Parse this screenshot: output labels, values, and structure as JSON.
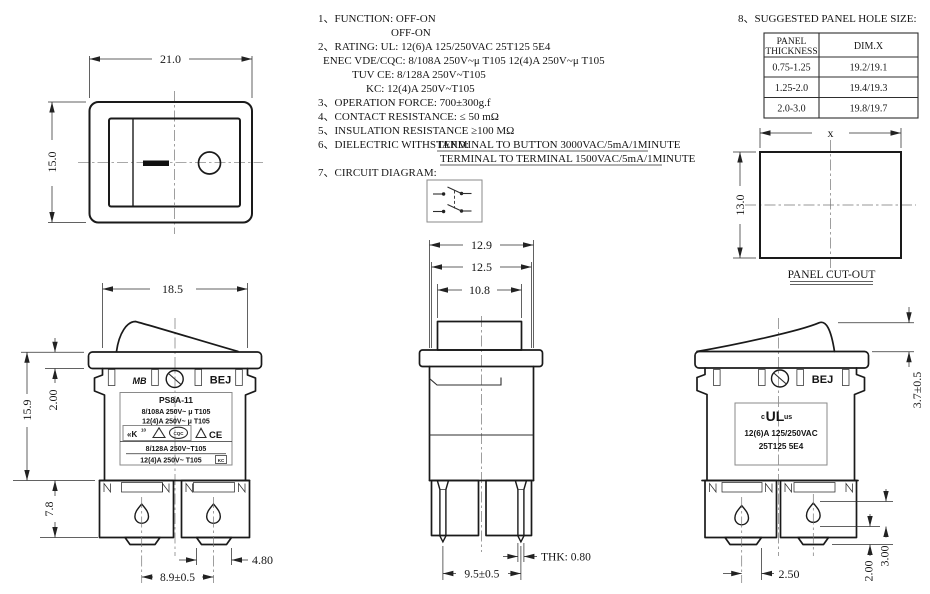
{
  "specs": {
    "l1": "1、FUNCTION:  OFF-ON",
    "l2": "OFF-ON",
    "l3": "2、RATING:   UL:  12(6)A  125/250VAC  25T125  5E4",
    "l4": "ENEC  VDE/CQC:  8/108A  250V~μ  T105    12(4)A  250V~μ  T105",
    "l5": "TUV  CE: 8/128A  250V~T105",
    "l6": "KC: 12(4)A  250V~T105",
    "l7": "3、OPERATION  FORCE: 700±300g.f",
    "l8": "4、CONTACT  RESISTANCE:  ≤ 50  mΩ",
    "l9": "5、INSULATION  RESISTANCE   ≥100  MΩ",
    "l10a": "6、DIELECTRIC  WITHSTAND:",
    "l10b": "TERMINAL  TO  BUTTON  3000VAC/5mA/1MINUTE",
    "l11": "TERMINAL  TO  TERMINAL  1500VAC/5mA/1MINUTE",
    "l12": "7、CIRCUIT  DIAGRAM:"
  },
  "table": {
    "heading": "8、SUGGESTED  PANEL  HOLE  SIZE:",
    "h1a": "PANEL",
    "h1b": "THICKNESS",
    "h2": "DIM.X",
    "r1t": "0.75-1.25",
    "r1x": "19.2/19.1",
    "r2t": "1.25-2.0",
    "r2x": "19.4/19.3",
    "r3t": "2.0-3.0",
    "r3x": "19.8/19.7"
  },
  "cutout": {
    "x": "x",
    "h": "13.0",
    "caption": "PANEL CUT-OUT"
  },
  "front": {
    "w": "21.0",
    "h": "15.0"
  },
  "left": {
    "w": "18.5",
    "h": "15.9",
    "flange": "2.00",
    "termh": "7.8",
    "pitch": "8.9±0.5",
    "foot": "4.80",
    "logo": "MB",
    "brand": "BEJ",
    "model": "PS8A-11",
    "r1": "8/108A  250V~ μ  T105",
    "r2": "12(4)A  250V~ μ  T105",
    "r3": "8/128A  250V~T105",
    "r4": "12(4)A  250V~ T105",
    "k": "«K",
    "k10": "10",
    "cqc": "CQC",
    "ce": "CE",
    "kc": "KC"
  },
  "mid": {
    "d1": "12.9",
    "d2": "12.5",
    "d3": "10.8",
    "thk": "THK: 0.80",
    "pitch": "9.5±0.5"
  },
  "right": {
    "brand": "BEJ",
    "h": "3.7±0.5",
    "p": "2.50",
    "d2": "2.00",
    "d3": "3.00",
    "ulc": "c",
    "ul": "UL",
    "ulus": "us",
    "r1": "12(6)A 125/250VAC",
    "r2": "25T125 5E4"
  }
}
